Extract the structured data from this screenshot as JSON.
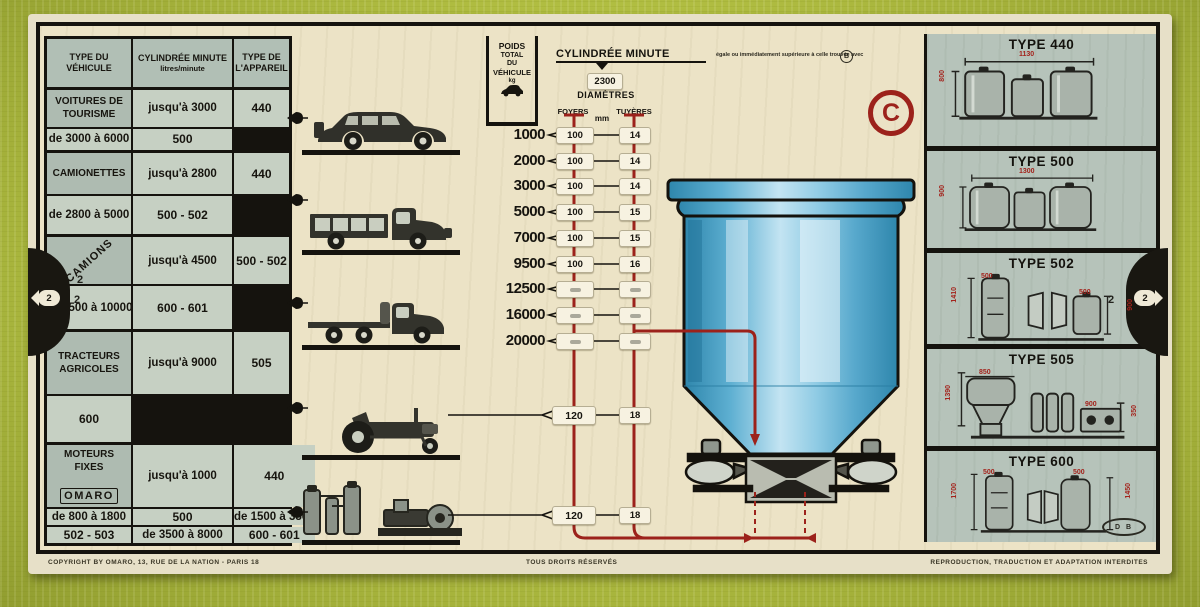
{
  "card": {
    "center_logo": "C",
    "notch_label": "2"
  },
  "left_table": {
    "headers": {
      "col1": "TYPE DU VÉHICULE",
      "col2": "CYLINDRÉE MINUTE",
      "col2_sub": "litres/minute",
      "col3": "TYPE DE L'APPAREIL"
    },
    "groups": [
      {
        "name": "VOITURES DE TOURISME",
        "rows": [
          {
            "range": "jusqu'à 3000",
            "type": "440"
          },
          {
            "range": "de 3000 à 6000",
            "type": "500"
          }
        ]
      },
      {
        "name": "CAMIONETTES",
        "rows": [
          {
            "range": "jusqu'à 2800",
            "type": "440"
          },
          {
            "range": "de 2800 à 5000",
            "type": "500 - 502"
          }
        ]
      },
      {
        "name": "CAMIONS",
        "badge": "2",
        "rows": [
          {
            "range": "jusqu'à 4500",
            "type": "500 - 502"
          },
          {
            "range": "de 4500 à 10000",
            "type": "600 - 601"
          }
        ]
      },
      {
        "name": "TRACTEURS AGRICOLES",
        "rows": [
          {
            "range": "jusqu'à 9000",
            "type": "505"
          },
          {
            "type": "600"
          }
        ]
      },
      {
        "name": "MOTEURS FIXES",
        "rows": [
          {
            "range": "jusqu'à 1000",
            "type": "440"
          },
          {
            "range": "de 800 à 1800",
            "type": "500"
          },
          {
            "range": "de 1500 à 3500",
            "type": "502 - 503"
          },
          {
            "range": "de 3500 à 8000",
            "type": "600 - 601"
          }
        ]
      }
    ],
    "logo": "OMARO"
  },
  "vehicles": {
    "labels": [
      "voiture de tourisme",
      "camionnette",
      "camion",
      "tracteur agricole",
      "moteur fixe"
    ]
  },
  "scale": {
    "poids_header": {
      "l1": "POIDS",
      "l2": "TOTAL",
      "l3": "DU",
      "l4": "VÉHICULE",
      "unit": "kg"
    },
    "title": "CYLINDRÉE MINUTE",
    "title_note": "égale ou immédiatement supérieure à celle trouvée avec",
    "title_note_badge": "B",
    "cursor_value": "2300",
    "diametres": "DIAMÈTRES",
    "foyers": "FOYERS",
    "mm": "mm",
    "tuyeres": "TUYÈRES",
    "rows": [
      {
        "poids": "1000",
        "foyer": "100",
        "tuyere": "14"
      },
      {
        "poids": "2000",
        "foyer": "100",
        "tuyere": "14"
      },
      {
        "poids": "3000",
        "foyer": "100",
        "tuyere": "14"
      },
      {
        "poids": "5000",
        "foyer": "100",
        "tuyere": "15"
      },
      {
        "poids": "7000",
        "foyer": "100",
        "tuyere": "15"
      },
      {
        "poids": "9500",
        "foyer": "100",
        "tuyere": "16"
      },
      {
        "poids": "12500",
        "foyer": "",
        "tuyere": ""
      },
      {
        "poids": "16000",
        "foyer": "",
        "tuyere": ""
      },
      {
        "poids": "20000",
        "foyer": "",
        "tuyere": ""
      }
    ],
    "extra_rows": [
      {
        "foyer": "120",
        "tuyere": "18"
      },
      {
        "foyer": "120",
        "tuyere": "18"
      }
    ]
  },
  "right_panel": {
    "sections": [
      {
        "title": "TYPE 440",
        "dim_top": "1130",
        "dim_left": "800"
      },
      {
        "title": "TYPE 500",
        "dim_top": "1300",
        "dim_left": "900"
      },
      {
        "title": "TYPE 502",
        "dim_top": "500",
        "dim_left": "1410",
        "dim_top2": "500",
        "dim_right": "900"
      },
      {
        "title": "TYPE 505",
        "dim_top": "850",
        "dim_left": "1390",
        "dim_top2": "900",
        "dim_right": "350"
      },
      {
        "title": "TYPE 600",
        "dim_top": "500",
        "dim_left": "1700",
        "dim_top2": "500",
        "dim_right": "1450"
      }
    ],
    "maker_logo": "D B"
  },
  "footer": {
    "left": "COPYRIGHT BY OMARO, 13, RUE DE LA NATION - PARIS 18",
    "center": "TOUS DROITS RÉSERVÉS",
    "right": "REPRODUCTION, TRADUCTION ET ADAPTATION INTERDITES"
  }
}
